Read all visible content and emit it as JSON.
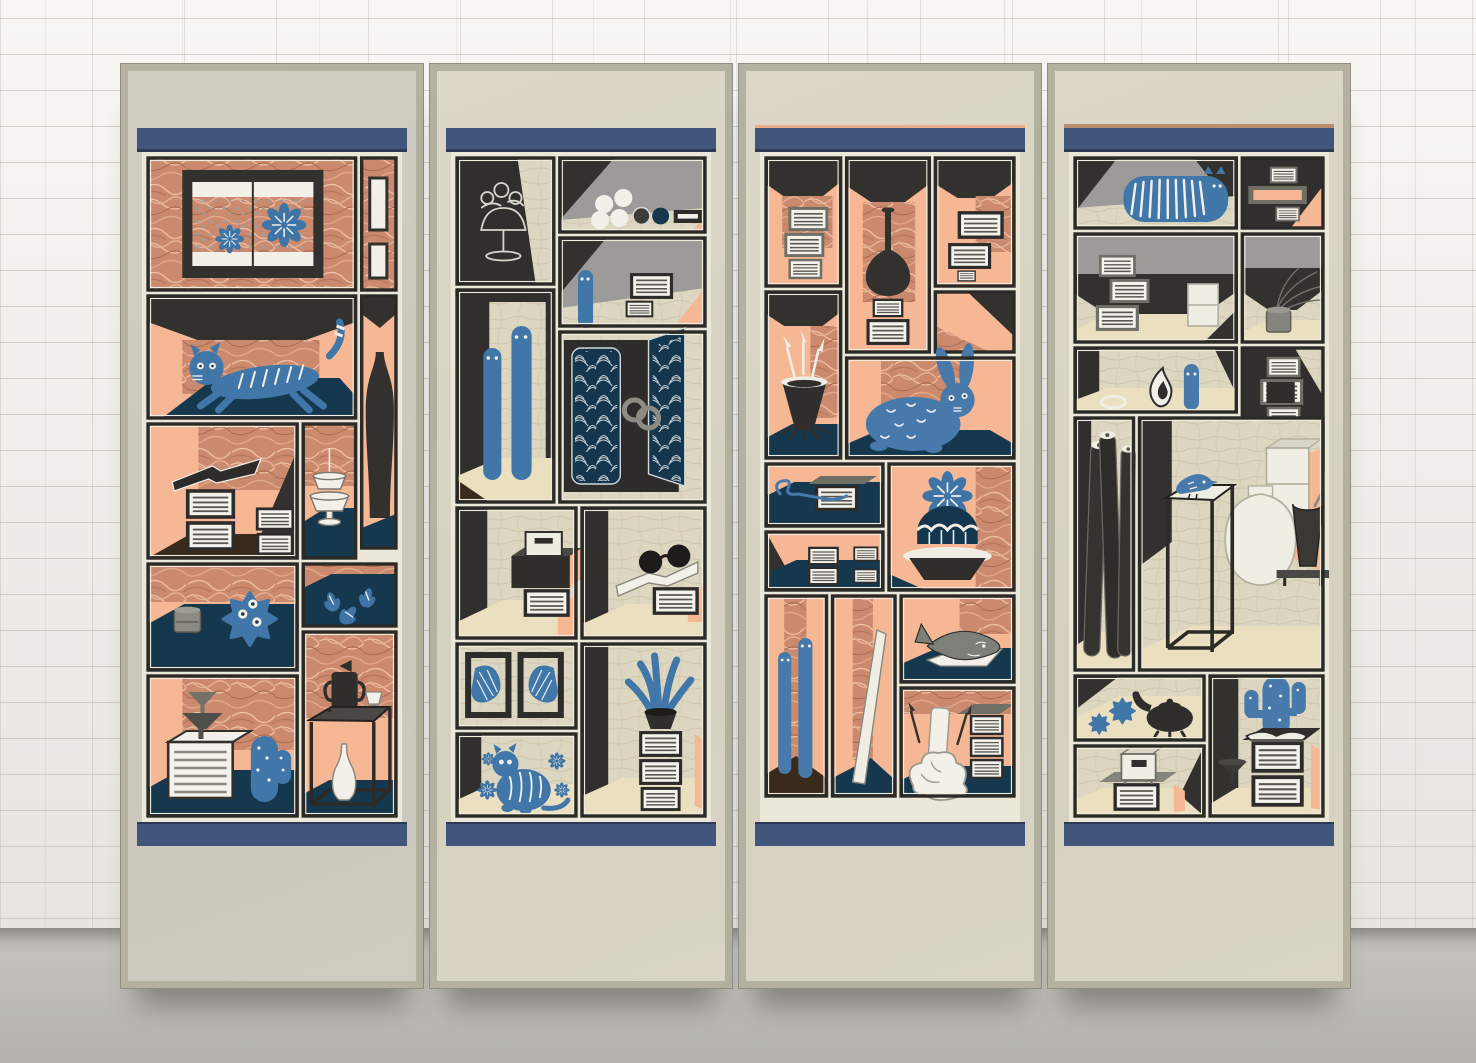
{
  "scene": {
    "type": "product mockup photograph",
    "subject": "four-panel folding screen decorated with chaekgeori-style shelf illustrations",
    "background": "white painted brick wall",
    "floor": "grey concrete floor",
    "panel_count": 4
  },
  "palette": {
    "wall": "#efede8",
    "floor": "#b4b3ae",
    "panel_frame": "#b5b1a0",
    "panel_paper": "#d9d4c3",
    "band_navy": "#42567c",
    "artwork_cream": "#ece8d9",
    "divider_black": "#2b2a27",
    "peach": "#f6b795",
    "copper_texture": "#cb8a6e",
    "linen_texture": "#ddd6c0",
    "grey_wall": "#9c9b99",
    "navy_floor": "#16384e",
    "object_blue": "#4077a8",
    "object_white": "#f2f0e8",
    "floor_cream": "#eadfbe"
  },
  "panels": [
    {
      "id": "panel-1",
      "theme": "copper-peach",
      "summary": "Panel 1: window with two blue flowers and confetti, stretching striped blue cat, dark bottle, pedestal cup, book stack with open book, blue leaves on shelf, spiky blue urchin with grey jar, double funnel on white book box with blue cactus, tall display stand with dark pitcher, white cup and long-neck white vase",
      "items": [
        "flower-window",
        "stretching-cat",
        "dark-bottle",
        "pedestal-cup",
        "book-stack-open-book",
        "blue-leaves",
        "spiky-urchin",
        "jar",
        "funnels-on-box",
        "round-cactus",
        "display-stand",
        "dark-pitcher",
        "white-vase"
      ]
    },
    {
      "id": "panel-2",
      "theme": "linen-grey",
      "summary": "Panel 2: outlined goblet with flowers, shelf of white eggs with navy ball and tray, peeking blue eel with books, two standing blue eels, cabinet with navy wave-patterned doors and ring handles, stacked boxes, open book with round glasses, two framed blue shells, tall blue coral on book stack, sitting striped blue cat with flowers",
      "items": [
        "outline-goblet",
        "egg-shelf",
        "peeking-eel",
        "book-stack",
        "standing-eels",
        "wave-door-cabinet",
        "stacked-boxes",
        "glasses-on-book",
        "framed-shells",
        "blue-coral",
        "sitting-cat",
        "blue-flowers"
      ]
    },
    {
      "id": "panel-3",
      "theme": "copper-peach",
      "summary": "Panel 3: book stacks, tall long-neck dark vase on books, brush pot with calligraphy brushes, blue rabbit with crescent spots, book bundle tied with blue thread, barrel cactus with big blue flower in dark bowl, two standing blue eels, leaning white board, grey catfish on white book, melting white candle in gnarled holder with brushes",
      "items": [
        "book-stacks",
        "long-neck-vase",
        "brush-pot",
        "blue-rabbit",
        "thread-tied-book",
        "cactus-flower-bowl",
        "standing-eels",
        "leaning-board",
        "catfish",
        "melting-candle"
      ]
    },
    {
      "id": "panel-4",
      "theme": "linen-grey",
      "summary": "Panel 4: striped blue hedgehog-cat, stepped book stacks with white box, wispy grass in grey pot, white flame bud with blue pillar figure, three rolled scrolls, blue bird on tall display stand, white moon jar with dark trumpet vase and white cabinet, blue urchins with dark kettle, white chest on book stack, saguaro cactus on large book stack with funnel",
      "items": [
        "striped-hedgehog",
        "book-stacks",
        "white-box",
        "grass-pot",
        "flame-bud",
        "blue-pillar-figure",
        "rolled-scrolls",
        "bird-on-stand",
        "moon-jar",
        "trumpet-vase",
        "white-cabinet",
        "urchins",
        "kettle",
        "chest-on-books",
        "saguaro-cactus",
        "funnel"
      ]
    }
  ]
}
